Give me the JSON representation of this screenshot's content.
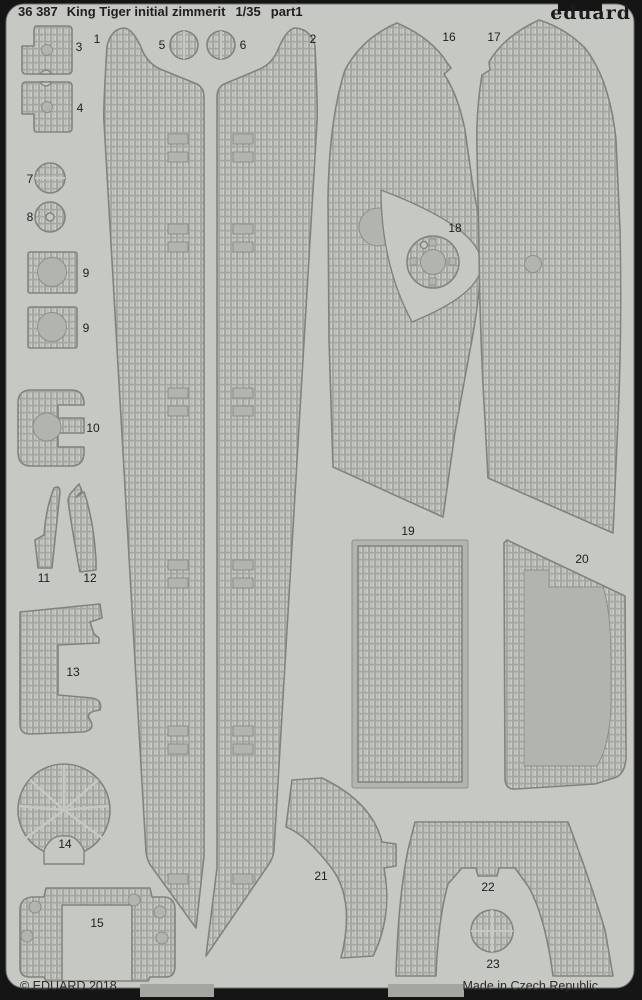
{
  "header": {
    "catalog_number": "36 387",
    "title": "King Tiger initial zimmerit",
    "scale": "1/35",
    "part_label": "part1",
    "brand": "eduard"
  },
  "footer": {
    "copyright": "© EDUARD 2018",
    "origin": "Made in Czech Republic"
  },
  "colors": {
    "background": "#151515",
    "sheet": "#c6c8c3",
    "part_plain": "#b2b4ae",
    "outline": "#82847c",
    "text": "#1f1f1f"
  },
  "parts": [
    {
      "label": "1"
    },
    {
      "label": "2"
    },
    {
      "label": "3"
    },
    {
      "label": "4"
    },
    {
      "label": "5"
    },
    {
      "label": "6"
    },
    {
      "label": "7"
    },
    {
      "label": "8"
    },
    {
      "label": "9"
    },
    {
      "label": "9"
    },
    {
      "label": "10"
    },
    {
      "label": "11"
    },
    {
      "label": "12"
    },
    {
      "label": "13"
    },
    {
      "label": "14"
    },
    {
      "label": "15"
    },
    {
      "label": "16"
    },
    {
      "label": "17"
    },
    {
      "label": "18"
    },
    {
      "label": "19"
    },
    {
      "label": "20"
    },
    {
      "label": "21"
    },
    {
      "label": "22"
    },
    {
      "label": "23"
    }
  ]
}
